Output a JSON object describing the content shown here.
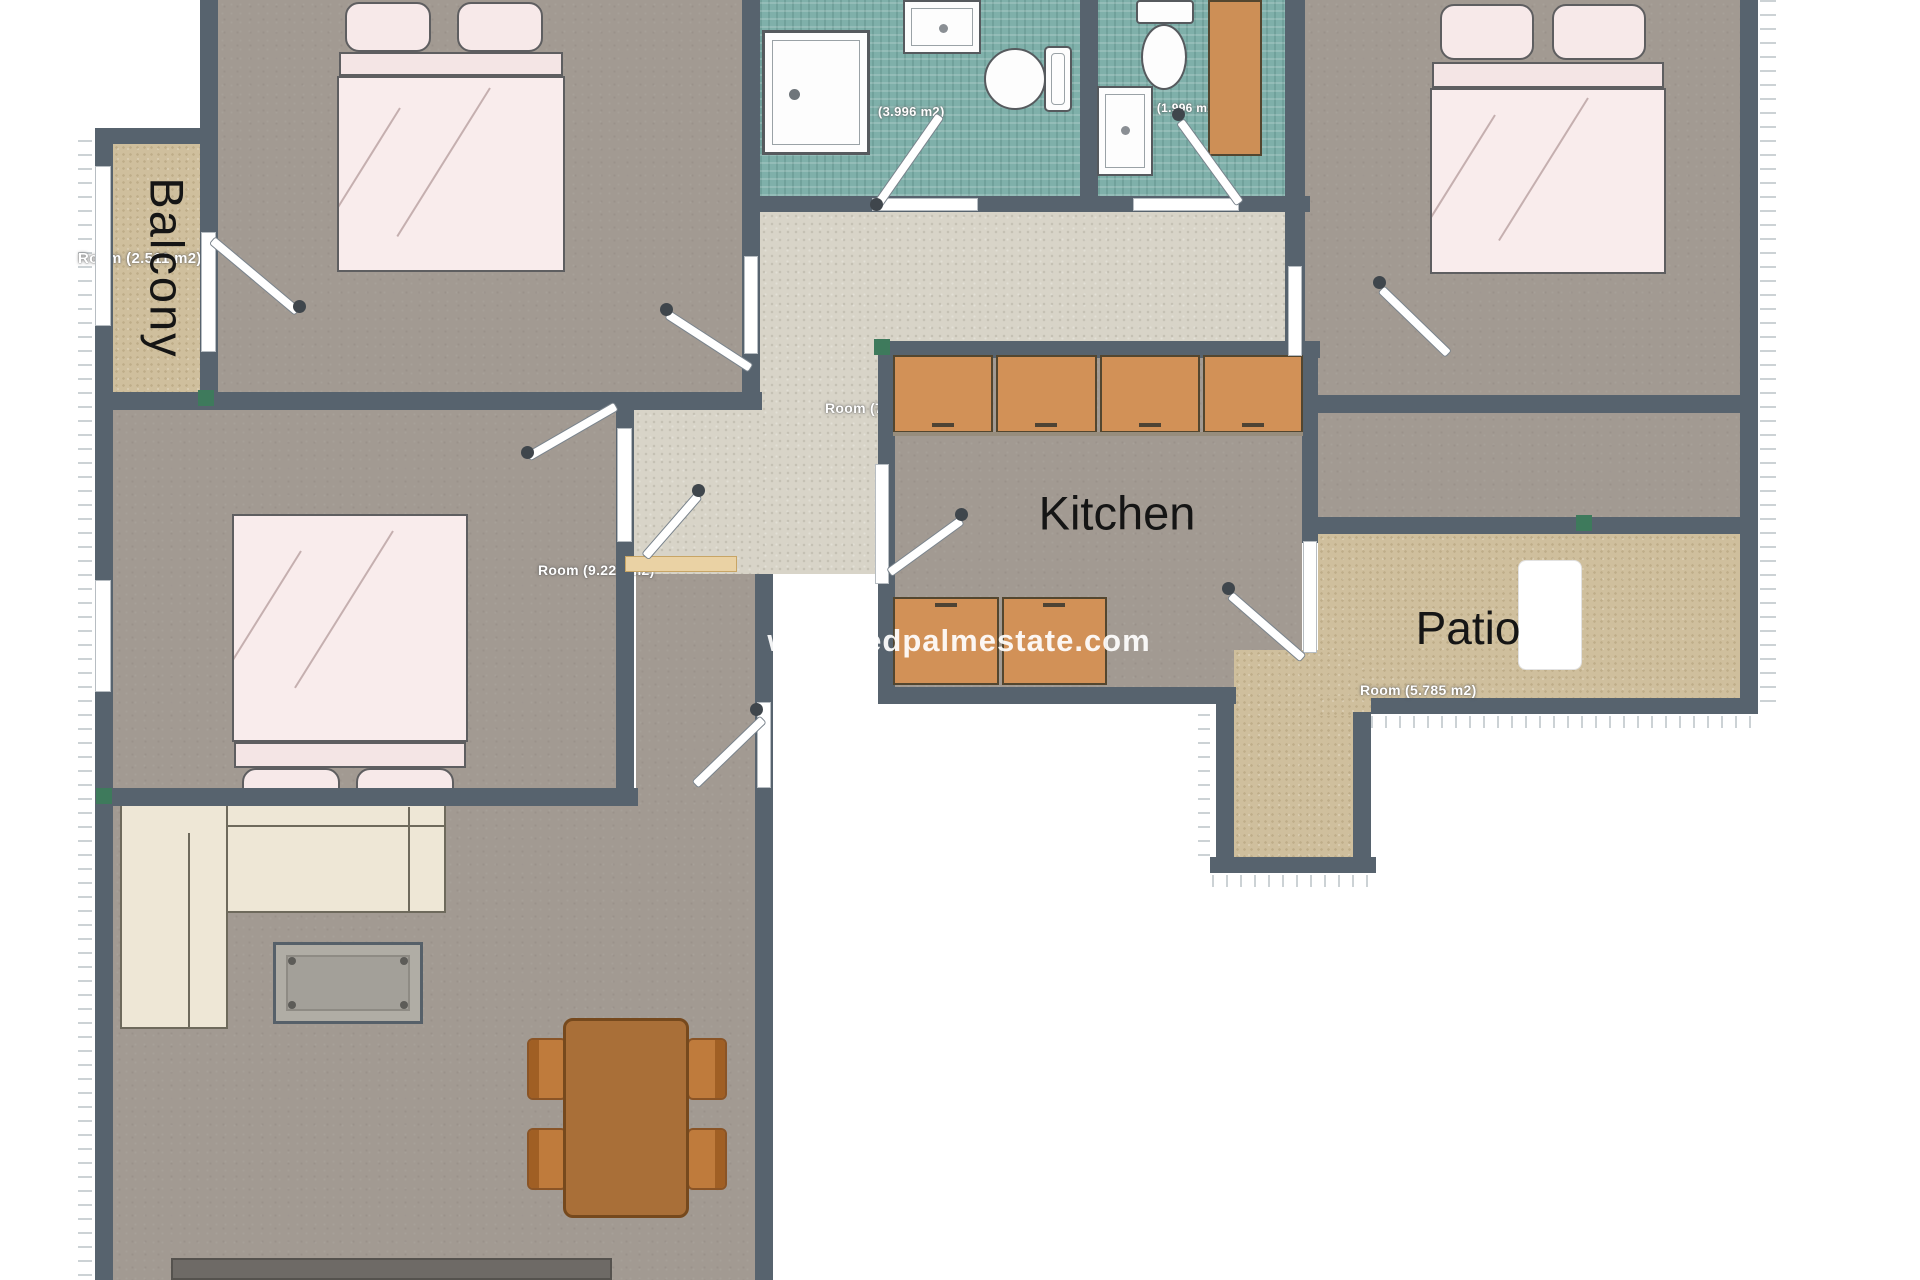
{
  "watermark": "www.redpalmestate.com",
  "labels": {
    "balcony": "Balcony",
    "kitchen": "Kitchen",
    "patio": "Patio"
  },
  "area_labels": {
    "bedroom_top_left": "Room (2.511 m2)",
    "bathroom_1": "(3.996 m2)",
    "bathroom_2": "Room (1.996 m2)",
    "hallway": "Room (7.852 m2)",
    "bedroom_mid_left": "Room (9.222 m2)",
    "patio": "Room (5.785 m2)"
  },
  "colors": {
    "wall": "#57636e",
    "floor": "#a29a92",
    "hall_floor": "#d8d4c8",
    "outdoor_floor": "#cfbf9d",
    "bathroom_floor": "#7fb0aa",
    "cabinet": "#d29157",
    "bed": "#f9ecec",
    "sofa": "#eee7d6",
    "dining": "#a96f38",
    "accent_green": "#3e7a5c",
    "label_text": "#ffffff",
    "room_text": "#151515"
  }
}
